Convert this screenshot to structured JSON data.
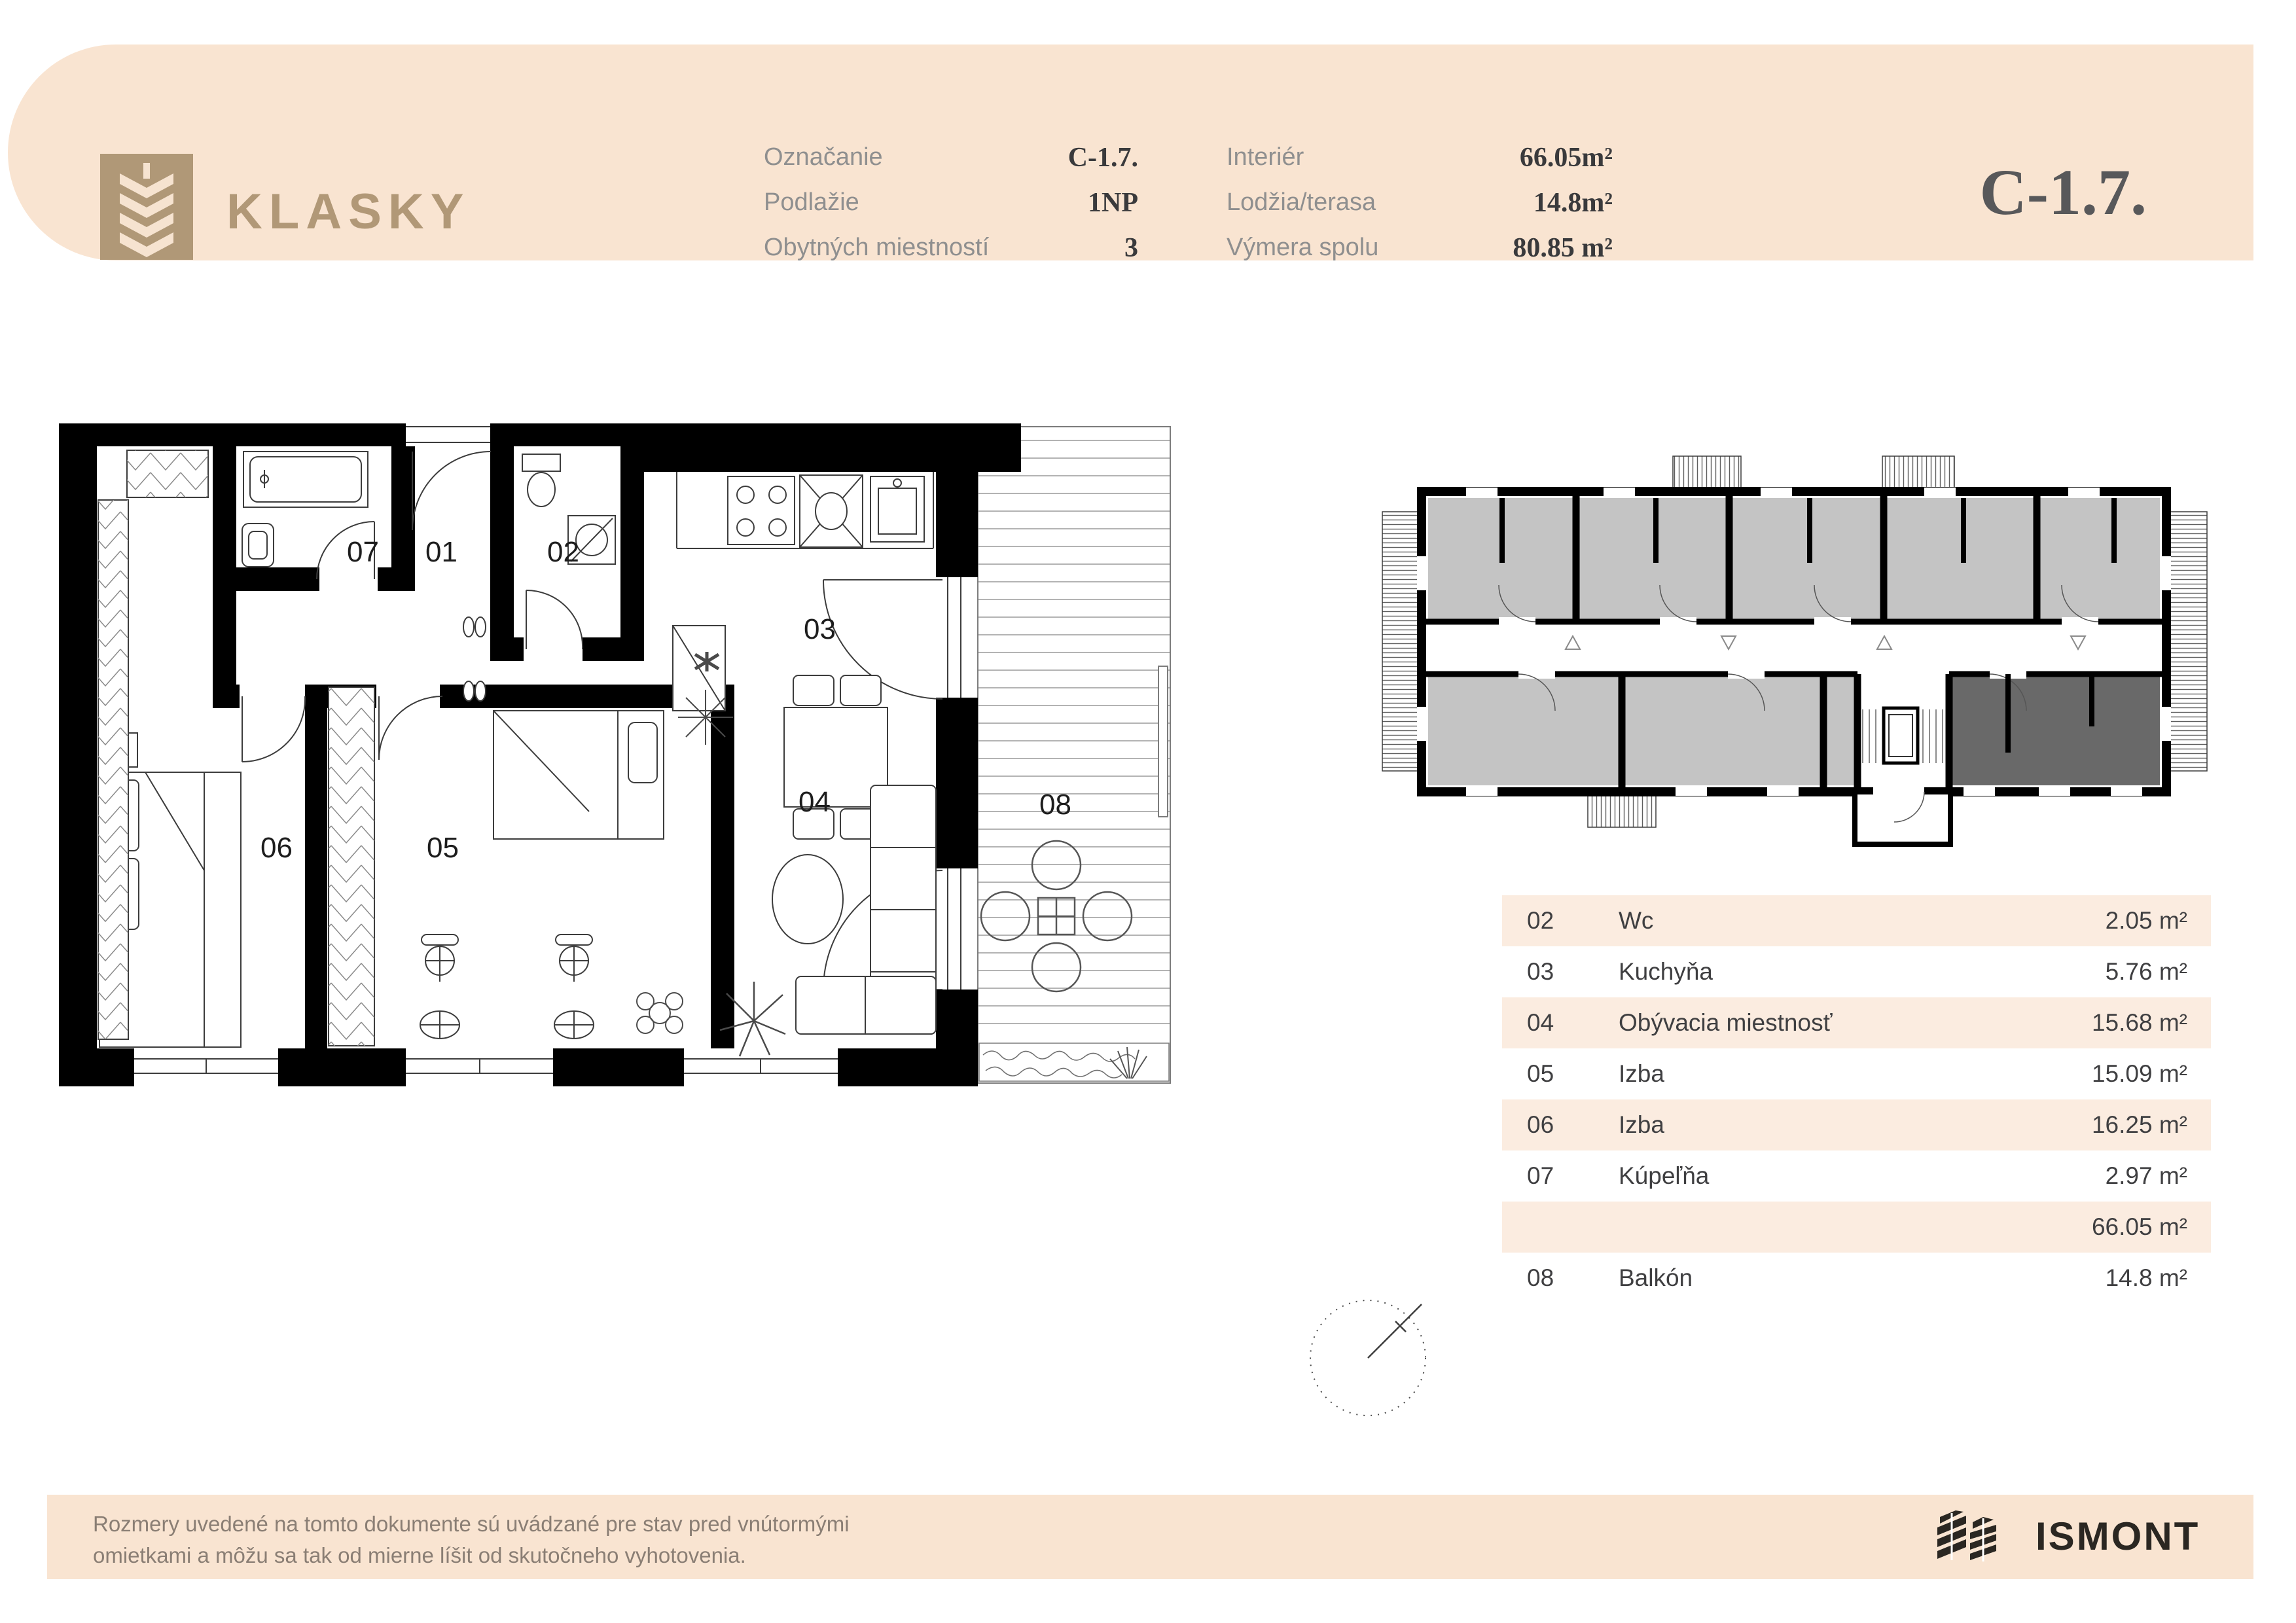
{
  "header": {
    "brand": "KLASKY",
    "unit_code_large": "C-1.7.",
    "fields_left": [
      {
        "label": "Označanie",
        "value": "C-1.7."
      },
      {
        "label": "Podlažie",
        "value": "1NP"
      },
      {
        "label": "Obytných miestností",
        "value": "3"
      }
    ],
    "fields_right": [
      {
        "label": "Interiér",
        "value": "66.05m²"
      },
      {
        "label": "Lodžia/terasa",
        "value": "14.8m²"
      },
      {
        "label": "Výmera spolu",
        "value": "80.85 m²"
      }
    ]
  },
  "plan": {
    "labels": [
      "07",
      "01",
      "02",
      "03",
      "06",
      "05",
      "04",
      "08"
    ]
  },
  "legend_table": {
    "rows": [
      {
        "num": "02",
        "name": "Wc",
        "area": "2.05 m²",
        "shaded": true
      },
      {
        "num": "03",
        "name": "Kuchyňa",
        "area": "5.76 m²",
        "shaded": false
      },
      {
        "num": "04",
        "name": "Obývacia miestnosť",
        "area": "15.68 m²",
        "shaded": true
      },
      {
        "num": "05",
        "name": "Izba",
        "area": "15.09 m²",
        "shaded": false
      },
      {
        "num": "06",
        "name": "Izba",
        "area": "16.25 m²",
        "shaded": true
      },
      {
        "num": "07",
        "name": "Kúpeľňa",
        "area": "2.97 m²",
        "shaded": false
      },
      {
        "num": "",
        "name": "",
        "area": "66.05 m²",
        "shaded": true
      },
      {
        "num": "08",
        "name": "Balkón",
        "area": "14.8 m²",
        "shaded": false
      }
    ]
  },
  "footer": {
    "line1": "Rozmery uvedené na tomto dokumente sú uvádzané pre stav pred vnútormými",
    "line2": "omietkami a môžu sa tak od mierne líšit od skutočneho vyhotovenia.",
    "brand": "ISMONT"
  },
  "colors": {
    "peach": "#f9e4d1",
    "row_shade": "#fbece0",
    "brand_tan": "#b19877",
    "value_dark": "#3a3a3c",
    "title_gray": "#58585a",
    "keyplan_unit_gray": "#c4c4c4",
    "keyplan_unit_highlight": "#696969"
  }
}
